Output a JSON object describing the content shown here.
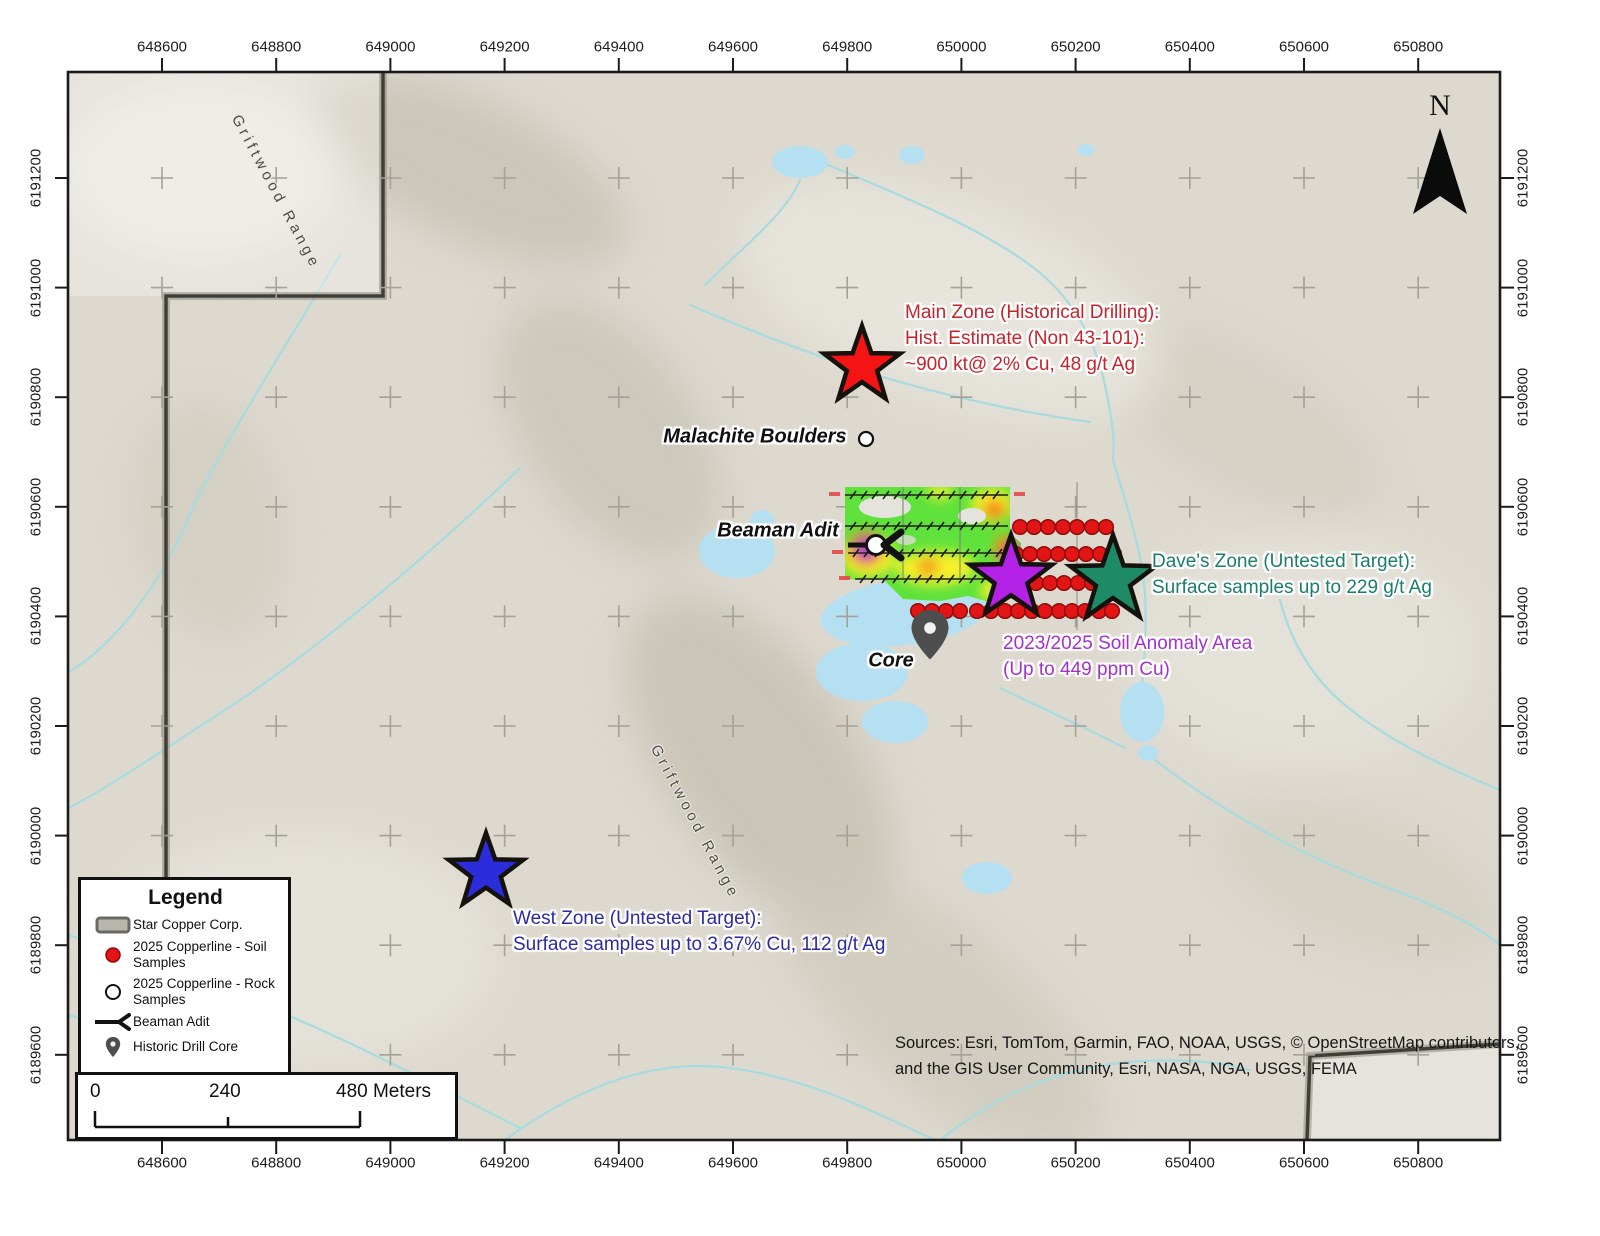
{
  "map": {
    "axis": {
      "x_labels": [
        "648600",
        "648800",
        "649000",
        "649200",
        "649400",
        "649600",
        "649800",
        "650000",
        "650200",
        "650400",
        "650600",
        "650800"
      ],
      "y_labels": [
        "6191200",
        "6191000",
        "6190800",
        "6190600",
        "6190400",
        "6190200",
        "6190000",
        "6189800",
        "6189600"
      ]
    },
    "north_label": "N",
    "labels": {
      "range_top": "Griftwood Range",
      "range_mid": "Griftwood Range",
      "malachite": "Malachite Boulders",
      "beaman_adit": "Beaman Adit",
      "core": "Core"
    },
    "annotations": {
      "main_zone": {
        "color": "#c8232b",
        "lines": [
          "Main Zone (Historical Drilling):",
          "Hist. Estimate (Non 43-101):",
          "~900 kt@ 2% Cu, 48 g/t Ag"
        ]
      },
      "daves_zone": {
        "color": "#1b7d6b",
        "lines": [
          "Dave's Zone (Untested Target):",
          "Surface samples up to 229 g/t Ag"
        ]
      },
      "soil_anomaly": {
        "color": "#a232cc",
        "lines": [
          "2023/2025 Soil Anomaly Area",
          "(Up to 449 ppm Cu)"
        ]
      },
      "west_zone": {
        "color": "#2b2ba6",
        "lines": [
          "West Zone (Untested Target):",
          "Surface samples up to 3.67% Cu, 112 g/t Ag"
        ]
      }
    },
    "stars": [
      {
        "name": "main-zone-star",
        "x": 862,
        "y": 366,
        "r": 40,
        "color": "#f51414"
      },
      {
        "name": "west-zone-star",
        "x": 486,
        "y": 872,
        "r": 39,
        "color": "#2b2cdc"
      },
      {
        "name": "soil-anomaly-star",
        "x": 1011,
        "y": 578,
        "r": 43,
        "color": "#b322e6"
      },
      {
        "name": "daves-zone-star",
        "x": 1113,
        "y": 580,
        "r": 45,
        "color": "#1f8a66"
      }
    ],
    "soil_dot_rows": [
      {
        "y": 527,
        "xs": [
          1020,
          1034,
          1048,
          1063,
          1077,
          1092,
          1106
        ]
      },
      {
        "y": 554,
        "xs": [
          1016,
          1030,
          1044,
          1058,
          1072,
          1086,
          1100,
          1114
        ]
      },
      {
        "y": 583,
        "xs": [
          1022,
          1036,
          1050,
          1064,
          1078,
          1092,
          1106
        ]
      },
      {
        "y": 611,
        "xs": [
          918,
          932,
          946,
          960,
          977,
          991,
          1005,
          1018,
          1032,
          1045,
          1059,
          1072,
          1085,
          1099,
          1112
        ]
      }
    ],
    "rock_samples": [
      {
        "x": 866,
        "y": 439
      },
      {
        "x": 876,
        "y": 545
      }
    ],
    "soil_grid": {
      "lines": [
        {
          "y": 495,
          "x1": 845,
          "x2": 1008
        },
        {
          "y": 526,
          "x1": 845,
          "x2": 1008
        },
        {
          "y": 553,
          "x1": 848,
          "x2": 1008
        },
        {
          "y": 579,
          "x1": 855,
          "x2": 1005
        }
      ]
    },
    "colors": {
      "soil_dot": "#e31414",
      "stream": "#a6dbdf",
      "lake": "#b5e0f2",
      "boundary": "#44423c"
    }
  },
  "legend": {
    "title": "Legend",
    "items": [
      {
        "label": "Star Copper Corp."
      },
      {
        "label": "2025 Copperline - Soil Samples"
      },
      {
        "label": "2025 Copperline - Rock Samples"
      },
      {
        "label": "Beaman Adit"
      },
      {
        "label": "Historic Drill Core"
      }
    ]
  },
  "scalebar": {
    "ticks": [
      "0",
      "240",
      "480 Meters"
    ]
  },
  "sources": {
    "line1": "Sources: Esri, TomTom, Garmin, FAO, NOAA, USGS, © OpenStreetMap contributors,",
    "line2": "and the GIS User Community, Esri, NASA, NGA, USGS, FEMA"
  }
}
